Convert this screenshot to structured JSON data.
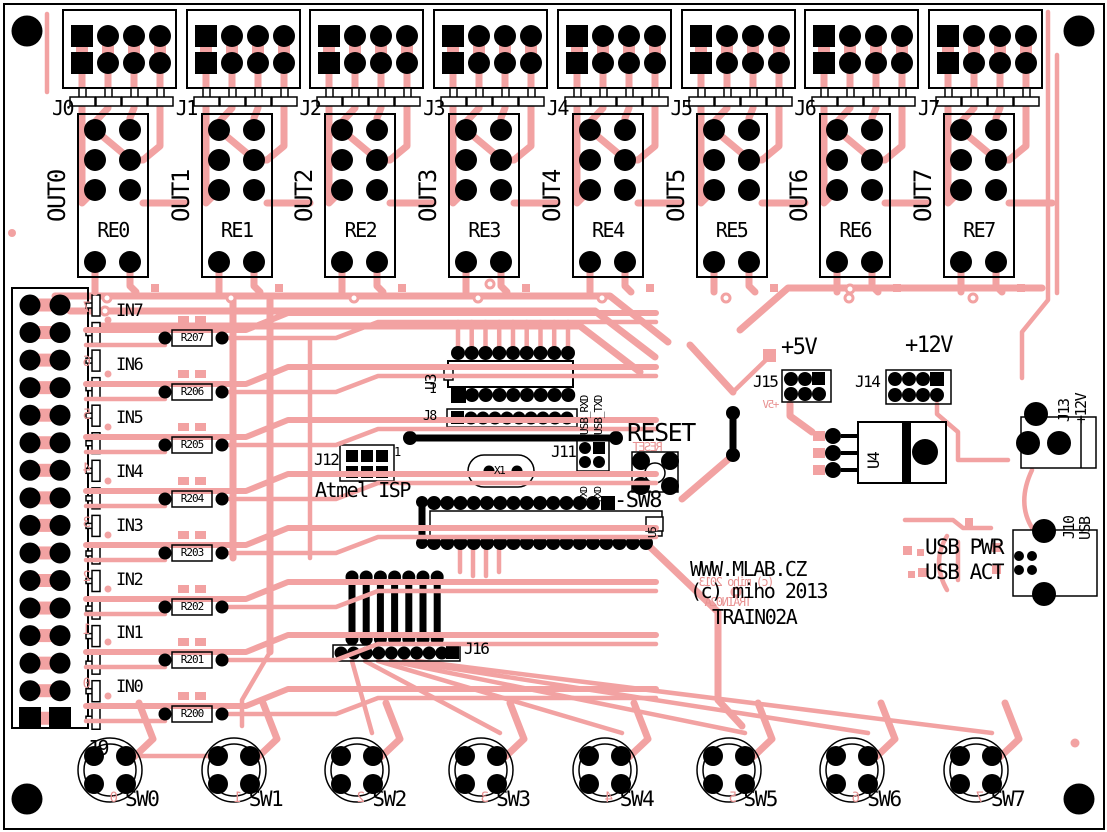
{
  "colors": {
    "copper": "#F2A2A2",
    "silk": "#000000",
    "silk_red": "#E89292",
    "board": "#FFFFFF"
  },
  "branding": {
    "url": "WWW.MLAB.CZ",
    "copyright": "(c) miho 2013",
    "board_name": "TRAIN02A",
    "copyright_mirror": "(c) miho 2013",
    "board_name_mirror": "TRAIN02A"
  },
  "output_channels": [
    {
      "connector": "J0",
      "net": "OUT0",
      "relay": "RE0"
    },
    {
      "connector": "J1",
      "net": "OUT1",
      "relay": "RE1"
    },
    {
      "connector": "J2",
      "net": "OUT2",
      "relay": "RE2"
    },
    {
      "connector": "J3",
      "net": "OUT3",
      "relay": "RE3"
    },
    {
      "connector": "J4",
      "net": "OUT4",
      "relay": "RE4"
    },
    {
      "connector": "J5",
      "net": "OUT5",
      "relay": "RE5"
    },
    {
      "connector": "J6",
      "net": "OUT6",
      "relay": "RE6"
    },
    {
      "connector": "J7",
      "net": "OUT7",
      "relay": "RE7"
    }
  ],
  "input_channels": [
    {
      "net": "IN7",
      "resistor": "R207",
      "digit": "7"
    },
    {
      "net": "IN6",
      "resistor": "R206",
      "digit": "6"
    },
    {
      "net": "IN5",
      "resistor": "R205",
      "digit": "5"
    },
    {
      "net": "IN4",
      "resistor": "R204",
      "digit": "4"
    },
    {
      "net": "IN3",
      "resistor": "R203",
      "digit": "3"
    },
    {
      "net": "IN2",
      "resistor": "R202",
      "digit": "2"
    },
    {
      "net": "IN1",
      "resistor": "R201",
      "digit": "1"
    },
    {
      "net": "IN0",
      "resistor": "R200",
      "digit": "0"
    }
  ],
  "switches": [
    {
      "label": "SW0",
      "digit": "0"
    },
    {
      "label": "SW1",
      "digit": "1"
    },
    {
      "label": "SW2",
      "digit": "2"
    },
    {
      "label": "SW3",
      "digit": "3"
    },
    {
      "label": "SW4",
      "digit": "4"
    },
    {
      "label": "SW5",
      "digit": "5"
    },
    {
      "label": "SW6",
      "digit": "6"
    },
    {
      "label": "SW7",
      "digit": "7"
    }
  ],
  "left_connector": {
    "label": "J9"
  },
  "center": {
    "u3": "U3",
    "u3_pin1": "1",
    "j8": "J8",
    "usb_rxd": "USB_RXD",
    "usb_txd": "USB_TXD",
    "j11": "J11",
    "txd": "TXD",
    "rxd": "RXD",
    "crystal": "X1",
    "j12": "J12",
    "j12_pin1": "1",
    "j12_name": "Atmel ISP",
    "reset": "RESET",
    "reset_mirror": "RESET",
    "sw8": "-SW8",
    "u5": "U5",
    "j16": "J16"
  },
  "power": {
    "plus5": "+5V",
    "plus5_mirror": "+5V",
    "j15": "J15",
    "plus12": "+12V",
    "j14": "J14",
    "u4": "U4",
    "j13": "J13",
    "j13_net": "+12V"
  },
  "usb": {
    "j10": "J10",
    "j10_net": "USB",
    "pwr_led": "USB PWR",
    "act_led": "USB ACT"
  }
}
